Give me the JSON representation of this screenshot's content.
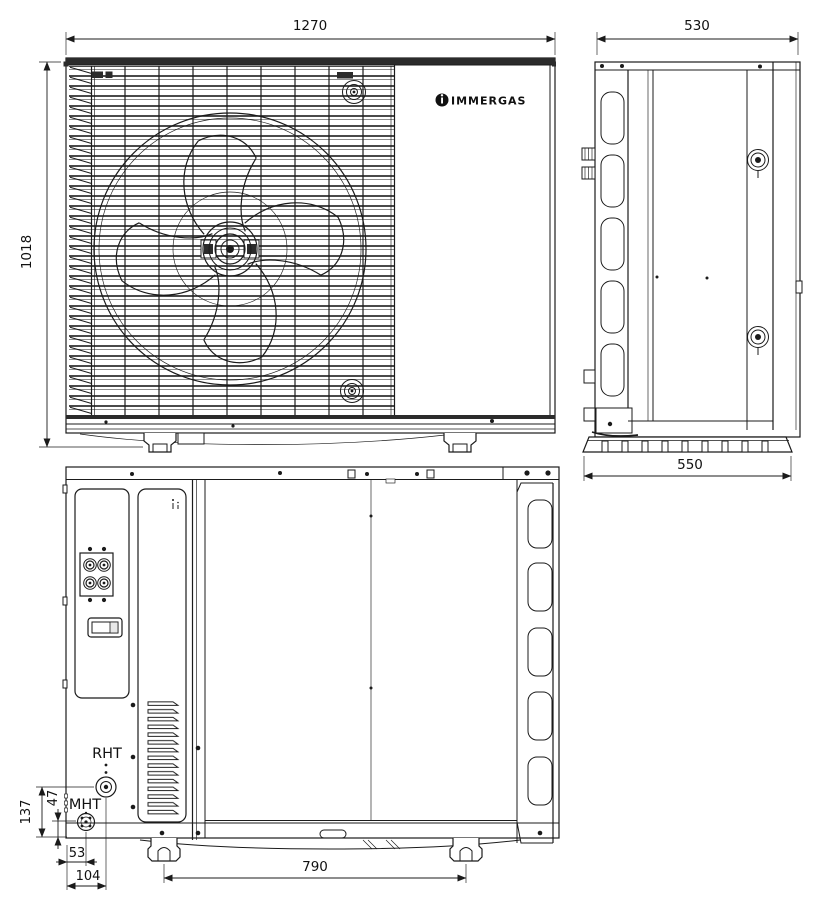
{
  "drawing": {
    "brand_logo": "IMMERGAS",
    "front_view": {
      "width": "1270",
      "height": "1018"
    },
    "side_view": {
      "depth_top": "530",
      "depth_base": "550"
    },
    "rear_view": {
      "port_rht": "RHT",
      "port_mht": "MHT",
      "dim_rht_height": "137",
      "dim_mht_height": "47",
      "dim_mht_offset": "53",
      "dim_rht_offset": "104",
      "dim_feet_spacing": "790"
    },
    "colors": {
      "line": "#1b1b1b",
      "background": "#ffffff",
      "logo": "#111111"
    }
  }
}
